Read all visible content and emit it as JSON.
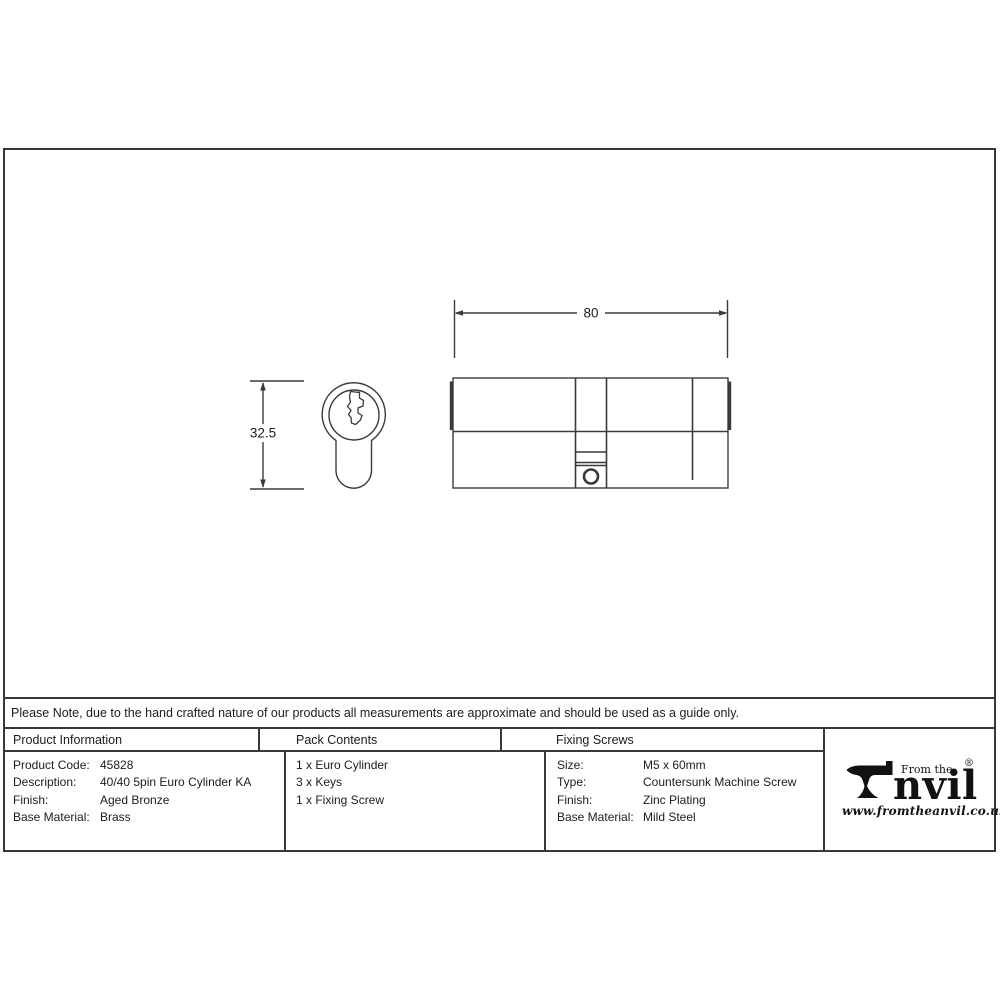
{
  "colors": {
    "line": "#383838",
    "text": "#1c1c1c",
    "background": "#ffffff"
  },
  "drawing": {
    "width_dim": "80",
    "height_dim": "32.5"
  },
  "note": {
    "text": "Please Note, due to the hand crafted nature of our products all measurements are approximate and should be used as a guide only."
  },
  "table": {
    "product_information": {
      "header": "Product Information",
      "rows": [
        {
          "label": "Product Code:",
          "value": "45828"
        },
        {
          "label": "Description:",
          "value": "40/40 5pin Euro Cylinder KA"
        },
        {
          "label": "Finish:",
          "value": "Aged Bronze"
        },
        {
          "label": "Base Material:",
          "value": "Brass"
        }
      ]
    },
    "pack_contents": {
      "header": "Pack Contents",
      "items": [
        "1 x Euro Cylinder",
        "3 x Keys",
        "1 x Fixing Screw"
      ]
    },
    "fixing_screws": {
      "header": "Fixing Screws",
      "rows": [
        {
          "label": "Size:",
          "value": "M5 x 60mm"
        },
        {
          "label": "Type:",
          "value": "Countersunk Machine Screw"
        },
        {
          "label": "Finish:",
          "value": "Zinc Plating"
        },
        {
          "label": "Base Material:",
          "value": "Mild Steel"
        }
      ]
    }
  },
  "logo": {
    "tagline": "From the",
    "name": "nvil",
    "registered": "®",
    "website": "www.fromtheanvil.co.uk"
  }
}
